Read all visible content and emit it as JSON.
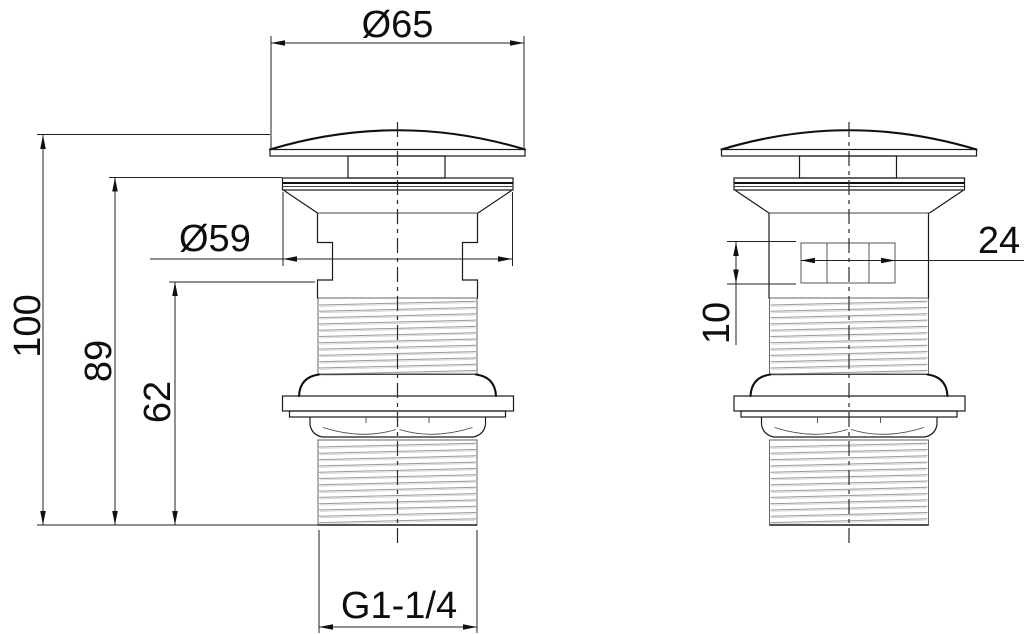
{
  "drawing": {
    "dimensions": {
      "cap_diameter": "Ø65",
      "flange_diameter": "Ø59",
      "overall_height": "100",
      "flange_height": "89",
      "thread_top_height": "62",
      "thread_size": "G1-1/4",
      "slot_width": "24",
      "slot_height": "10"
    },
    "colors": {
      "background": "#ffffff",
      "line": "#1a1a1a",
      "thread_line": "#9a9a9a"
    }
  }
}
